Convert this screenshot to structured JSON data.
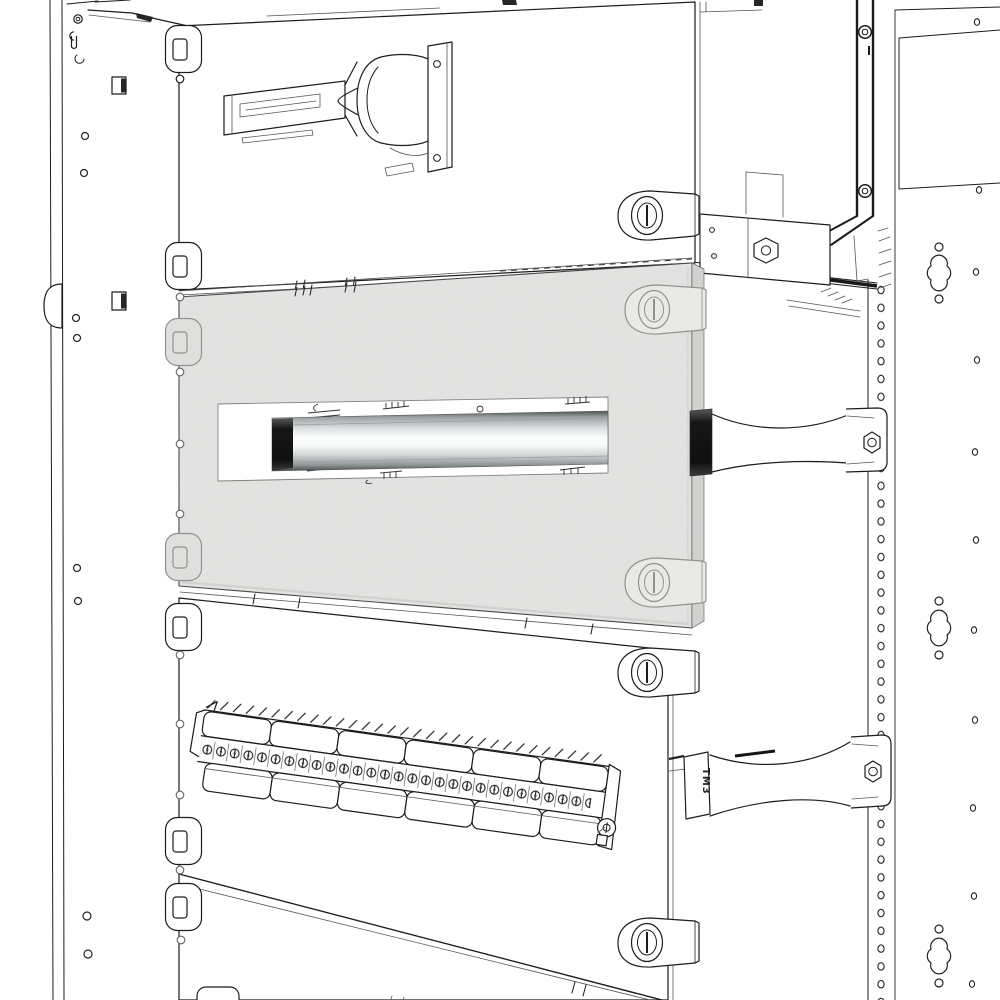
{
  "document": {
    "kind": "technical-line-drawing",
    "subject": "Modular DIN-rail window panel and terminal block strip installed in an electrical enclosure frame",
    "view": "isometric close-up, exploded hardware",
    "background": "#ffffff"
  },
  "labels": {
    "bracket_marking": "TM3"
  },
  "colors": {
    "line": "#1c1c1c",
    "panel_fill": "#e3e4e2",
    "panel_edge": "#d0d2cf",
    "latch_fill": "#e9eae8",
    "latch_stroke": "#90938f",
    "clip_fill": "#dfe0de"
  },
  "parts": [
    {
      "id": "upper-blind-panel",
      "label": "Upper blind panel with quarter-turn latch"
    },
    {
      "id": "lock-handle-assembly",
      "label": "Lock / handle assembly with mounting plate"
    },
    {
      "id": "din-rail-window-panel",
      "label": "Gray window panel with DIN rail cutout"
    },
    {
      "id": "din-rail",
      "label": "DIN rail (metallic) behind panel window"
    },
    {
      "id": "din-rail-bracket-upper",
      "label": "DIN rail depth-support bracket (upper)"
    },
    {
      "id": "din-rail-bracket-lower",
      "label": "DIN rail depth-support bracket (lower, marked TM3)"
    },
    {
      "id": "terminal-block-strip",
      "label": "Terminal block strip with hinged covers"
    },
    {
      "id": "lower-panel",
      "label": "Lower blind panel"
    },
    {
      "id": "left-frame-upright",
      "label": "Left frame upright with fixing holes"
    },
    {
      "id": "right-frame-upright",
      "label": "Right frame upright with hole rows and quatrefoil slots"
    },
    {
      "id": "panel-latch",
      "label": "Quarter-turn panel latch"
    },
    {
      "id": "panel-clip",
      "label": "Panel retaining clip"
    }
  ],
  "counts": {
    "cover_flaps_per_row": 6,
    "terminal_screws_visible": 28,
    "panel_latches_visible": 5,
    "din_rail_brackets": 2,
    "quatrefoil_slots": 3
  }
}
